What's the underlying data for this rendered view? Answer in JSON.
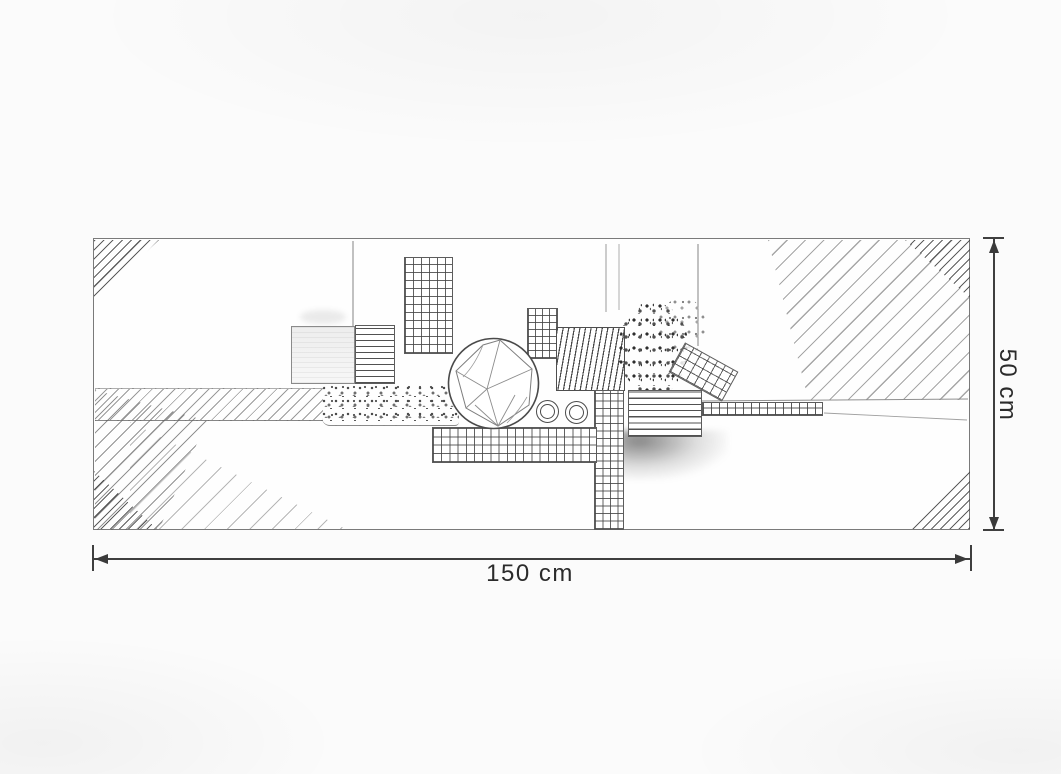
{
  "plan": {
    "width_label": "150 cm",
    "height_label": "50 cm"
  },
  "style": {
    "paper_color": "#fbfbfb",
    "pencil_line_color": "#6e6e6e",
    "dimension_line_color": "#3f3f3f",
    "label_text_color": "#2b2b2b"
  }
}
